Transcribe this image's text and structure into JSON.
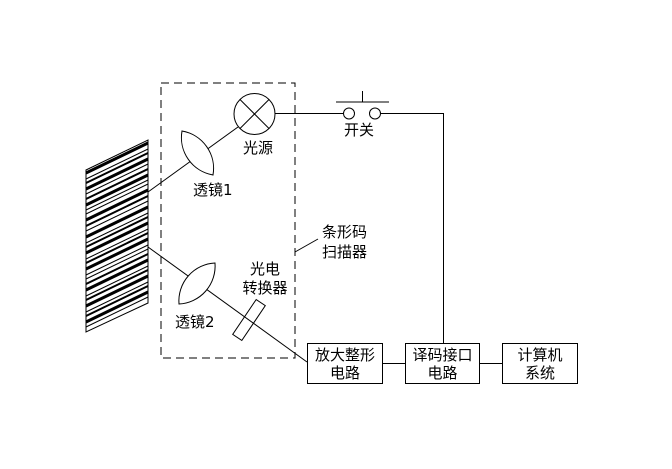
{
  "colors": {
    "line": "#000000",
    "background": "#ffffff"
  },
  "labels": {
    "light_source": "光源",
    "lens1": "透镜1",
    "lens2": "透镜2",
    "photo_converter": "光电\n转换器",
    "scanner_callout": "条形码\n扫描器",
    "switch": "开关"
  },
  "boxes": [
    {
      "label": "放大整形\n电路"
    },
    {
      "label": "译码接口\n电路"
    },
    {
      "label": "计算机\n系统"
    }
  ],
  "barcode": {
    "stripes": [
      {
        "o": 2,
        "w": 3
      },
      {
        "o": 8,
        "w": 1
      },
      {
        "o": 12,
        "w": 2
      },
      {
        "o": 18,
        "w": 3
      },
      {
        "o": 23,
        "w": 1
      },
      {
        "o": 28,
        "w": 2
      },
      {
        "o": 34,
        "w": 3
      },
      {
        "o": 39,
        "w": 1
      },
      {
        "o": 43,
        "w": 1
      },
      {
        "o": 49,
        "w": 3
      },
      {
        "o": 55,
        "w": 2
      },
      {
        "o": 60,
        "w": 1
      },
      {
        "o": 66,
        "w": 3
      },
      {
        "o": 72,
        "w": 1
      },
      {
        "o": 76,
        "w": 2
      },
      {
        "o": 82,
        "w": 3
      },
      {
        "o": 88,
        "w": 1
      },
      {
        "o": 92,
        "w": 2
      },
      {
        "o": 98,
        "w": 3
      },
      {
        "o": 104,
        "w": 1
      },
      {
        "o": 108,
        "w": 1
      },
      {
        "o": 113,
        "w": 2
      },
      {
        "o": 119,
        "w": 3
      },
      {
        "o": 125,
        "w": 1
      },
      {
        "o": 129,
        "w": 2
      },
      {
        "o": 135,
        "w": 3
      },
      {
        "o": 141,
        "w": 1
      },
      {
        "o": 145,
        "w": 2
      },
      {
        "o": 151,
        "w": 3
      },
      {
        "o": 156,
        "w": 1
      }
    ]
  }
}
